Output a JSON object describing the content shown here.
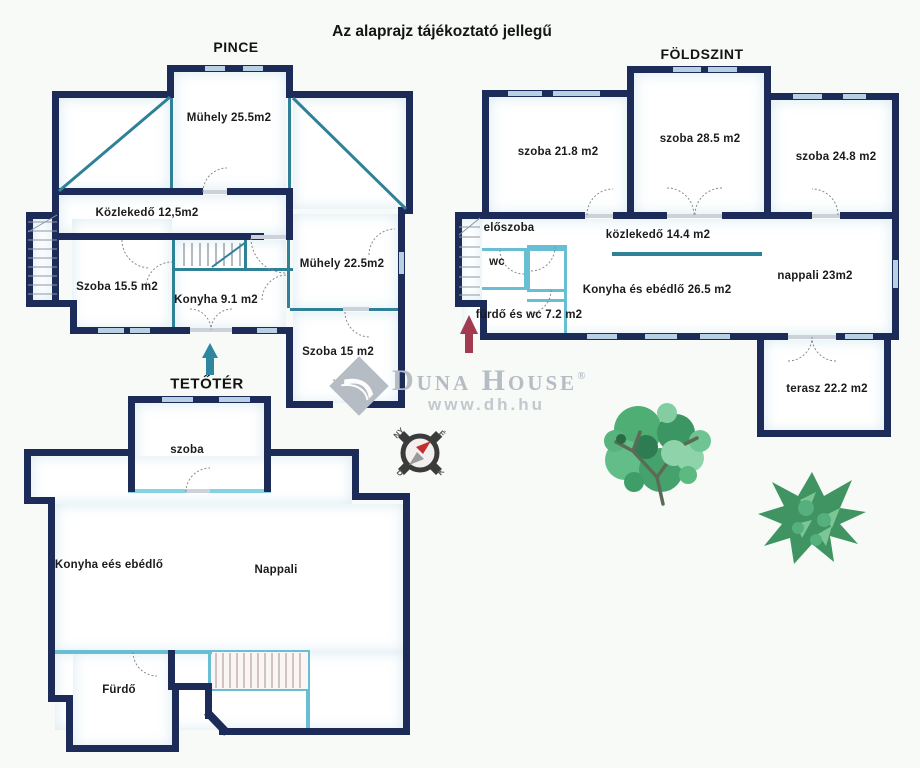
{
  "title": "Az alaprajz tájékoztató jellegű",
  "pince": {
    "label": "PINCE",
    "rooms": [
      "Mühely 25.5m2",
      "Közlekedő 12,5m2",
      "Szoba 15.5 m2",
      "Konyha 9.1 m2",
      "Mühely 22.5m2",
      "Szoba 15 m2"
    ]
  },
  "foldszint": {
    "label": "FÖLDSZINT",
    "rooms": [
      "szoba 21.8 m2",
      "szoba 28.5 m2",
      "szoba 24.8 m2",
      "előszoba",
      "közlekedő 14.4 m2",
      "wc",
      "nappali 23m2",
      "Konyha és ebédlő 26.5 m2",
      "fürdő és wc 7.2 m2",
      "terasz 22.2 m2"
    ]
  },
  "tetoter": {
    "label": "TETŐTÉR",
    "rooms": [
      "szoba",
      "Konyha eés ebédlő",
      "Nappali",
      "Fürdő"
    ]
  },
  "compass": {
    "n": "É",
    "e": "K",
    "s": "D",
    "w": "NY"
  },
  "watermark": {
    "brand": "Duna House",
    "reg": "®",
    "url": "www.dh.hu"
  },
  "colors": {
    "wall": "#1d2b59",
    "teal": "#2f8198",
    "light_teal": "#68bed2",
    "window": "#b7d0e3",
    "up_arrow": "#2e86a0",
    "entry_arrow": "#a23a50",
    "tree_green": "#4fae74",
    "watermark_gray": "#b6bcc3"
  }
}
